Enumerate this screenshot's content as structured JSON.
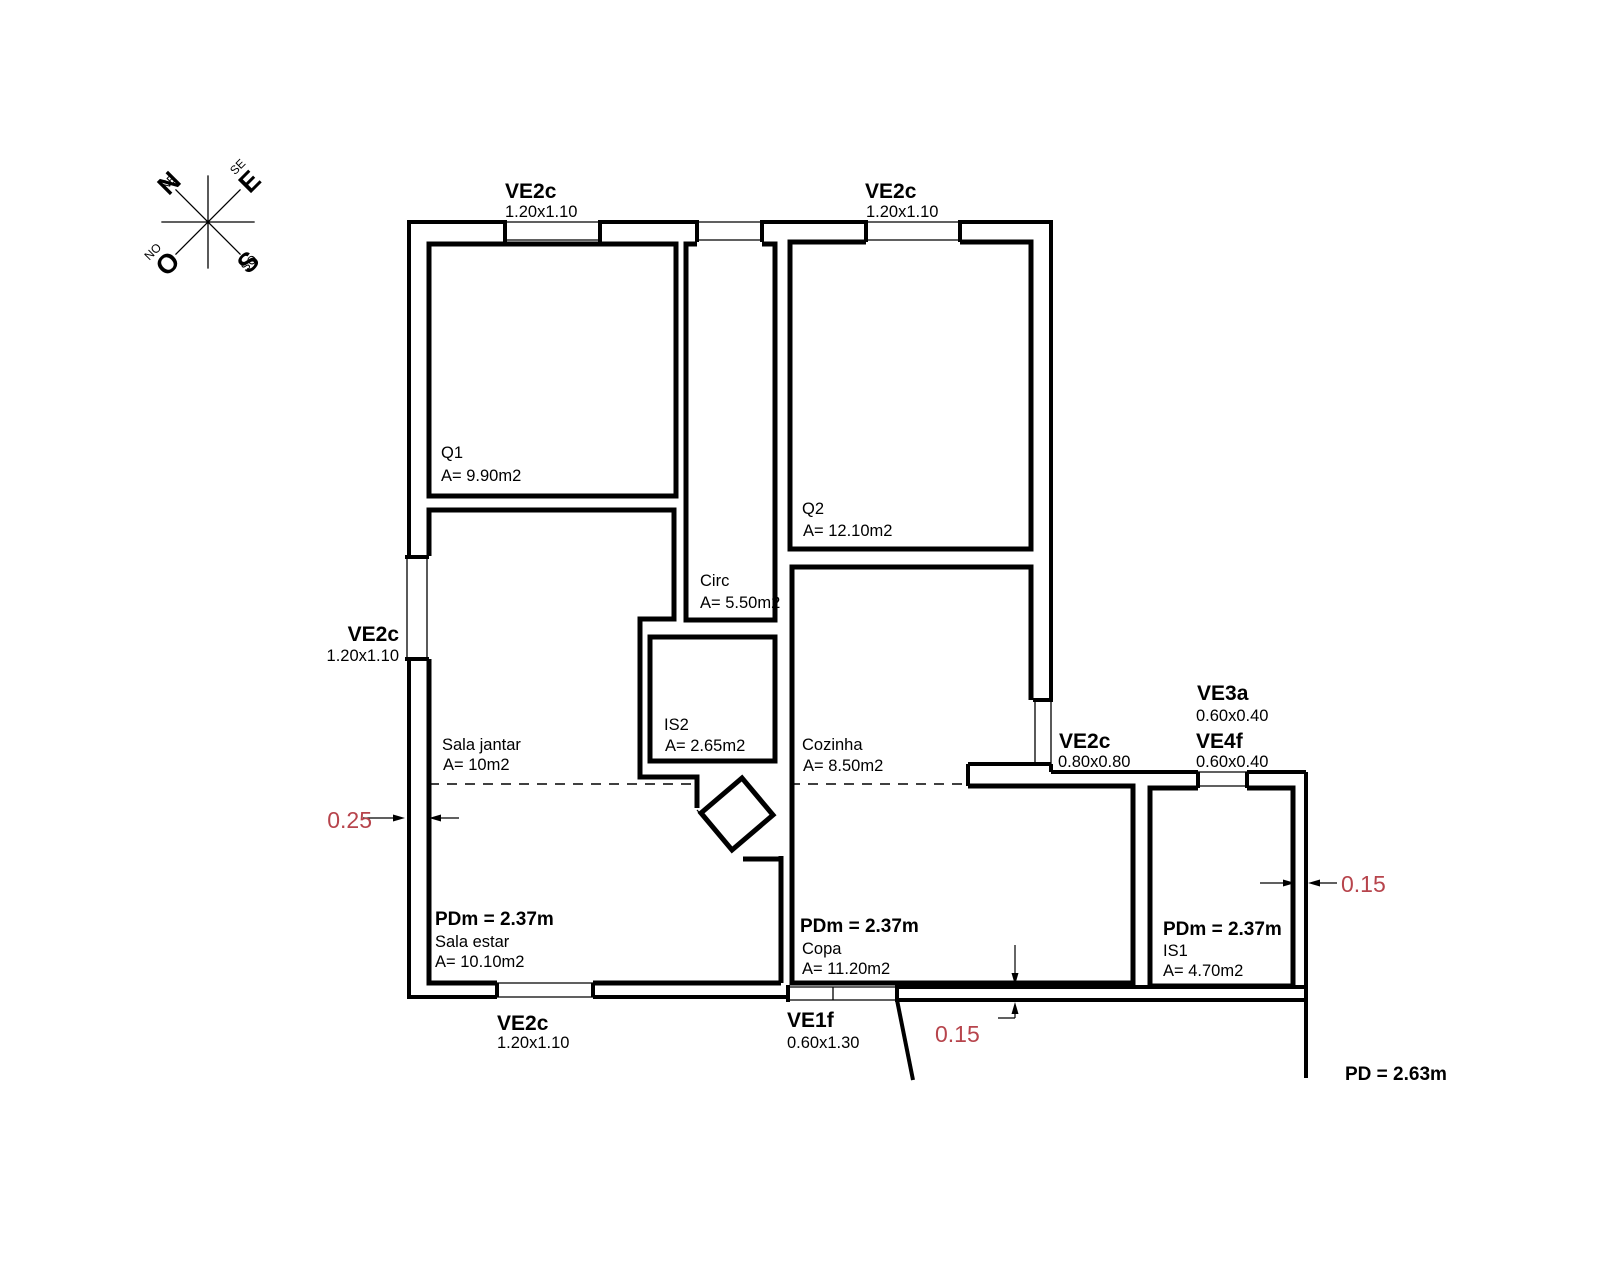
{
  "colors": {
    "line": "#000000",
    "dimension_red": "#b7444c",
    "background": "#ffffff"
  },
  "compass": {
    "n": "N",
    "e": "E",
    "s": "S",
    "o": "O",
    "ne": "NE",
    "se": "SE",
    "so": "SO",
    "no": "NO"
  },
  "windows": {
    "top_left": {
      "name": "VE2c",
      "size": "1.20x1.10"
    },
    "top_right": {
      "name": "VE2c",
      "size": "1.20x1.10"
    },
    "left": {
      "name": "VE2c",
      "size": "1.20x1.10"
    },
    "bottom": {
      "name": "VE2c",
      "size": "1.20x1.10"
    },
    "entry": {
      "name": "VE1f",
      "size": "0.60x1.30"
    },
    "right": {
      "name": "VE2c",
      "size": "0.80x0.80"
    },
    "ve3a": {
      "name": "VE3a",
      "size": "0.60x0.40"
    },
    "ve4f": {
      "name": "VE4f",
      "size": "0.60x0.40"
    }
  },
  "rooms": {
    "q1": {
      "name": "Q1",
      "area": "A= 9.90m2"
    },
    "q2": {
      "name": "Q2",
      "area": "A= 12.10m2"
    },
    "circ": {
      "name": "Circ",
      "area": "A= 5.50m2"
    },
    "is2": {
      "name": "IS2",
      "area": "A= 2.65m2"
    },
    "cozinha": {
      "name": "Cozinha",
      "area": "A= 8.50m2"
    },
    "sala_jantar": {
      "name": "Sala jantar",
      "area": "A= 10m2"
    },
    "sala_estar": {
      "name": "Sala estar",
      "area": "A= 10.10m2",
      "ceiling": "PDm = 2.37m"
    },
    "copa": {
      "name": "Copa",
      "area": "A= 11.20m2",
      "ceiling": "PDm = 2.37m"
    },
    "is1": {
      "name": "IS1",
      "area": "A= 4.70m2",
      "ceiling": "PDm = 2.37m"
    }
  },
  "annotations": {
    "pd": "PD = 2.63m",
    "dim_wall_left": "0.25",
    "dim_wall_bottom": "0.15",
    "dim_wall_right": "0.15"
  }
}
